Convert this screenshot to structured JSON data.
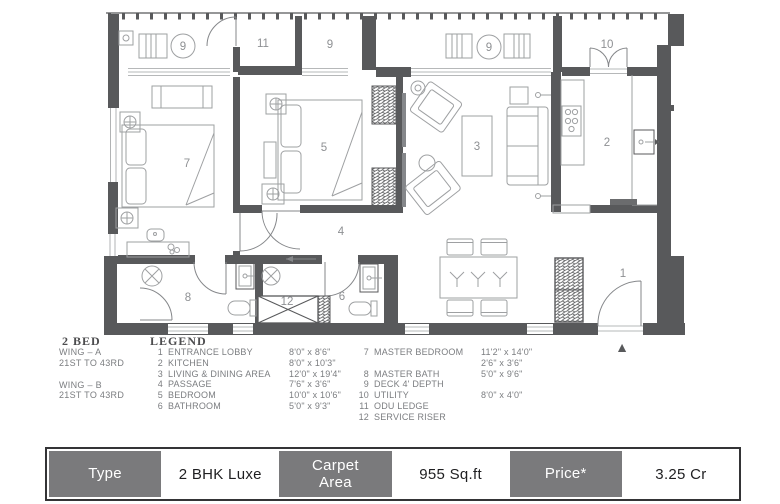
{
  "plan": {
    "room_labels": [
      {
        "text": "9"
      },
      {
        "text": "11"
      },
      {
        "text": "9"
      },
      {
        "text": "9"
      },
      {
        "text": "10"
      },
      {
        "text": "7"
      },
      {
        "text": "5"
      },
      {
        "text": "3"
      },
      {
        "text": "2"
      },
      {
        "text": "4"
      },
      {
        "text": "8"
      },
      {
        "text": "12"
      },
      {
        "text": "6"
      },
      {
        "text": "1"
      }
    ],
    "entry_marker": "▲"
  },
  "wing": {
    "bed": "2 BED",
    "wing_a": "WING – A",
    "wing_a_floors": "21ST TO 43RD",
    "wing_b": "WING – B",
    "wing_b_floors": "21ST TO 43RD"
  },
  "legend": {
    "title": "LEGEND",
    "col1": [
      {
        "num": "1",
        "name": "ENTRANCE LOBBY",
        "dim": "8'0\" x 8'6\""
      },
      {
        "num": "2",
        "name": "KITCHEN",
        "dim": "8'0\" x 10'3\""
      },
      {
        "num": "3",
        "name": "LIVING & DINING AREA",
        "dim": "12'0\" x 19'4\""
      },
      {
        "num": "4",
        "name": "PASSAGE",
        "dim": "7'6\" x 3'6\""
      },
      {
        "num": "5",
        "name": "BEDROOM",
        "dim": "10'0\" x 10'6\""
      },
      {
        "num": "6",
        "name": "BATHROOM",
        "dim": "5'0\" x 9'3\""
      }
    ],
    "col2": [
      {
        "num": "7",
        "name": "MASTER BEDROOM",
        "dim": "11'2\" x 14'0\""
      },
      {
        "num": "",
        "name": "",
        "dim": "2'6\" x 3'6\""
      },
      {
        "num": "8",
        "name": "MASTER BATH",
        "dim": "5'0\" x 9'6\""
      },
      {
        "num": "9",
        "name": "DECK 4' DEPTH",
        "dim": ""
      },
      {
        "num": "10",
        "name": "UTILITY",
        "dim": "8'0\" x 4'0\""
      },
      {
        "num": "11",
        "name": "ODU LEDGE",
        "dim": ""
      },
      {
        "num": "12",
        "name": "SERVICE RISER",
        "dim": ""
      }
    ]
  },
  "spec_table": {
    "cells": [
      {
        "label": "Type",
        "header": true
      },
      {
        "label": "2 BHK Luxe",
        "header": false
      },
      {
        "label": "Carpet Area",
        "header": true
      },
      {
        "label": "955 Sq.ft",
        "header": false
      },
      {
        "label": "Price*",
        "header": true
      },
      {
        "label": "3.25 Cr",
        "header": false
      }
    ]
  },
  "colors": {
    "wall": "#58595B",
    "furniture_line": "#9EA0A2",
    "door_line": "#85878A",
    "label_text": "#8E9093",
    "table_gray": "#7A7A7C",
    "table_border": "#343436"
  }
}
